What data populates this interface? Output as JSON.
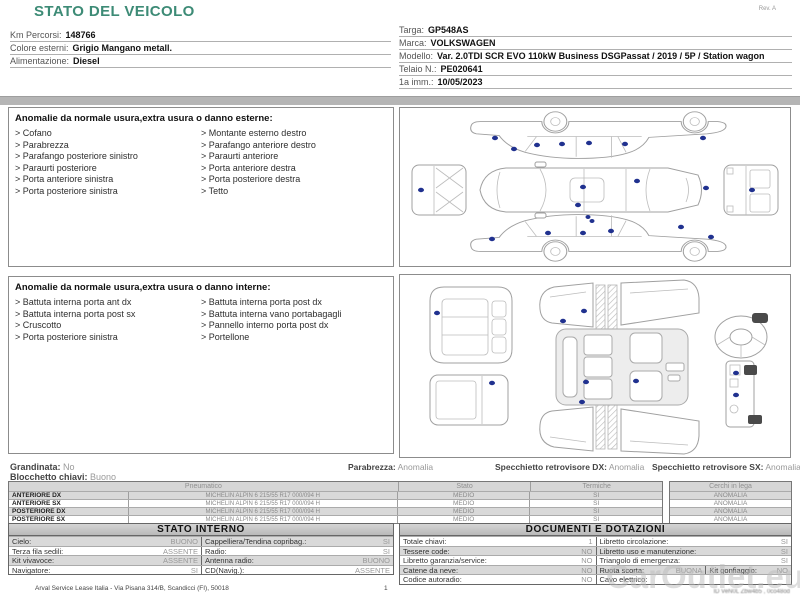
{
  "header": {
    "title": "STATO DEL VEICOLO",
    "rev": "Rev. A"
  },
  "vehicle_info": {
    "left": [
      {
        "label": "Km Percorsi:",
        "value": "148766"
      },
      {
        "label": "Colore esterni:",
        "value": "Grigio Mangano metall."
      },
      {
        "label": "Alimentazione:",
        "value": "Diesel"
      }
    ],
    "right": [
      {
        "label": "Targa:",
        "value": "GP548AS"
      },
      {
        "label": "Marca:",
        "value": "VOLKSWAGEN"
      },
      {
        "label": "Modello:",
        "value": "Var. 2.0TDI SCR EVO 110kW Business DSGPassat / 2019 / 5P / Station wagon"
      },
      {
        "label": "Telaio N.:",
        "value": "PE020641"
      },
      {
        "label": "1a imm.:",
        "value": "10/05/2023"
      }
    ]
  },
  "external_anomalies": {
    "title": "Anomalie da normale usura,extra usura o danno esterne:",
    "left": [
      "Cofano",
      "Parabrezza",
      "Parafango posteriore sinistro",
      "Paraurti posteriore",
      "Porta anteriore sinistra",
      "Porta posteriore sinistra"
    ],
    "right": [
      "Montante esterno destro",
      "Parafango anteriore destro",
      "Paraurti anteriore",
      "Porta anteriore destra",
      "Porta posteriore destra",
      "Tetto"
    ]
  },
  "internal_anomalies": {
    "title": "Anomalie da normale usura,extra usura o danno interne:",
    "left": [
      "Battuta interna porta ant dx",
      "Battuta interna porta post sx",
      "Cruscotto",
      "Porta posteriore sinistra"
    ],
    "right": [
      "Battuta interna porta post dx",
      "Battuta interna vano portabagagli",
      "Pannello interno porta post dx",
      "Portellone"
    ]
  },
  "condition_summary": {
    "grandinata": {
      "label": "Grandinata:",
      "value": "No"
    },
    "blocchetto": {
      "label": "Blocchetto chiavi:",
      "value": "Buono"
    },
    "parabrezza": {
      "label": "Parabrezza:",
      "value": "Anomalia"
    },
    "specchietto_dx": {
      "label": "Specchietto retrovisore DX:",
      "value": "Anomalia"
    },
    "specchietto_sx": {
      "label": "Specchietto retrovisore SX:",
      "value": "Anomalia"
    }
  },
  "tyres": {
    "headers": {
      "pneumatico": "Pneumatico",
      "stato": "Stato",
      "termiche": "Termiche",
      "cerchi": "Cerchi in lega"
    },
    "rows": [
      {
        "position": "ANTERIORE DX",
        "desc": "MICHELIN ALPIN 6 215/55 R17 000/094 H",
        "stato": "MEDIO",
        "termiche": "SI",
        "cerchi": "ANOMALIA"
      },
      {
        "position": "ANTERIORE SX",
        "desc": "MICHELIN ALPIN 6 215/55 R17 000/094 H",
        "stato": "MEDIO",
        "termiche": "SI",
        "cerchi": "ANOMALIA"
      },
      {
        "position": "POSTERIORE DX",
        "desc": "MICHELIN ALPIN 6 215/55 R17 000/094 H",
        "stato": "MEDIO",
        "termiche": "SI",
        "cerchi": "ANOMALIA"
      },
      {
        "position": "POSTERIORE SX",
        "desc": "MICHELIN ALPIN 6 215/55 R17 000/094 H",
        "stato": "MEDIO",
        "termiche": "SI",
        "cerchi": "ANOMALIA"
      }
    ]
  },
  "stato_interno": {
    "title": "STATO INTERNO",
    "rows": [
      {
        "l": {
          "label": "Cielo:",
          "value": "BUONO"
        },
        "r": {
          "label": "Cappelliera/Tendina copribag.:",
          "value": "SI"
        }
      },
      {
        "l": {
          "label": "Terza fila sedili:",
          "value": "ASSENTE"
        },
        "r": {
          "label": "Radio:",
          "value": "SI"
        }
      },
      {
        "l": {
          "label": "Kit vivavoce:",
          "value": "ASSENTE"
        },
        "r": {
          "label": "Antenna radio:",
          "value": "BUONO"
        }
      },
      {
        "l": {
          "label": "Navigatore:",
          "value": "SI"
        },
        "r": {
          "label": "CD(Navig.):",
          "value": "ASSENTE"
        }
      }
    ]
  },
  "documenti": {
    "title": "DOCUMENTI E DOTAZIONI",
    "rows": [
      {
        "l": {
          "label": "Totale chiavi:",
          "value": "1"
        },
        "r": {
          "label": "Libretto circolazione:",
          "value": "SI"
        }
      },
      {
        "l": {
          "label": "Tessere code:",
          "value": "NO"
        },
        "r": {
          "label": "Libretto uso e manutenzione:",
          "value": "SI"
        }
      },
      {
        "l": {
          "label": "Libretto garanzia/service:",
          "value": "NO"
        },
        "r": {
          "label": "Triangolo di emergenza:",
          "value": "SI"
        }
      },
      {
        "l": {
          "label": "Catene da neve:",
          "value": "NO"
        },
        "r1": {
          "label": "Ruota scorta:",
          "value": "BUONA"
        },
        "r2": {
          "label": "Kit gonfiaggio:",
          "value": "NO"
        }
      },
      {
        "l": {
          "label": "Codice autoradio:",
          "value": "NO"
        },
        "r": {
          "label": "Cavo elettrico:",
          "value": ""
        }
      }
    ]
  },
  "footer": {
    "address": "Arval Service Lease Italia - Via Pisana 314/B, Scandicci (FI), 50018",
    "page": "1",
    "doc_code": "ID VeN0L Zbw4b5 , 0co48od",
    "watermark": "CarOutlet.eu"
  },
  "colors": {
    "title_teal": "#3D8B76",
    "damage_dot": "#20318f",
    "separator_gray": "#b5b5b5",
    "row_gray": "#d9d9d9",
    "table_header_gray": "#c4c4c4"
  }
}
